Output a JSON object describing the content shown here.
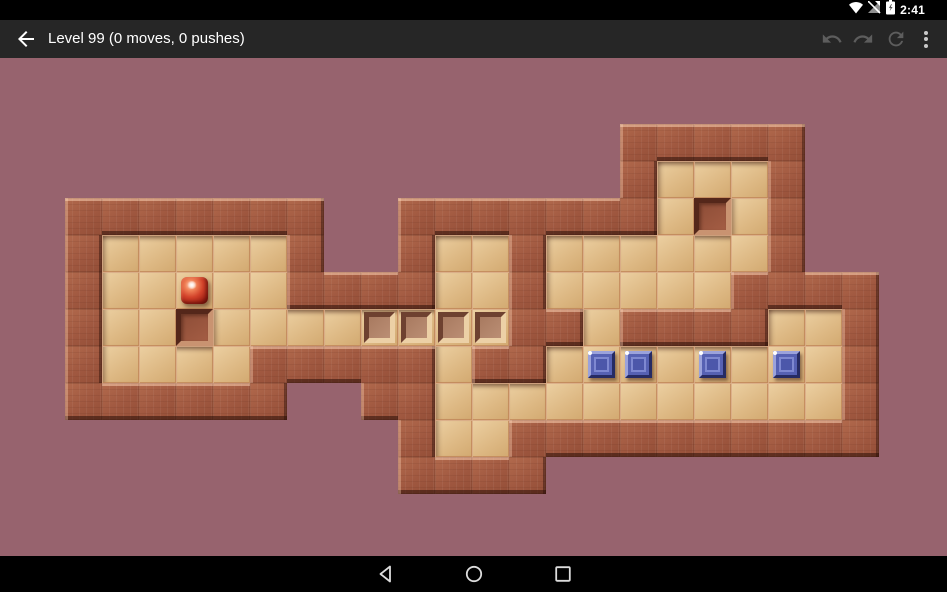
{
  "statusbar": {
    "time": "2:41",
    "icons": [
      "wifi-icon",
      "no-signal-icon",
      "battery-charging-icon"
    ]
  },
  "appbar": {
    "title": "Level 99 (0 moves, 0 pushes)",
    "back_label": "back",
    "actions": [
      "undo",
      "redo",
      "restart",
      "more-options"
    ]
  },
  "game": {
    "level_number": 99,
    "moves": 0,
    "pushes": 0,
    "board": {
      "tile_size": 37,
      "origin_x": 65,
      "origin_y": 66,
      "cols": 22,
      "rows": 10,
      "legend": {
        "#": "wall",
        " ": "outside",
        ".": "floor",
        "*": "goal",
        "$": "box",
        "@": "player"
      },
      "grid": [
        "               #####  ",
        "               #...#  ",
        "#######  #######.#.#  ",
        "#.....#  #..#......#  ",
        "#..@..####..#.....####",
        "#..#....****##.####..#",
        "#....#####.##.$$.$.$.#",
        "######  ##...........#",
        "         #..##########",
        "         ####         "
      ],
      "player": {
        "col": 3,
        "row": 4
      },
      "boxes": [
        {
          "col": 14,
          "row": 6
        },
        {
          "col": 15,
          "row": 6
        },
        {
          "col": 17,
          "row": 6
        },
        {
          "col": 19,
          "row": 6
        }
      ],
      "goals": [
        {
          "col": 8,
          "row": 5
        },
        {
          "col": 9,
          "row": 5
        },
        {
          "col": 10,
          "row": 5
        },
        {
          "col": 11,
          "row": 5
        }
      ]
    },
    "colors": {
      "background": "#97636e",
      "wall": "#a45c42",
      "wall_light_edge": "#d7a887",
      "wall_dark_edge": "#3f1a0f",
      "floor": "#e0bd8a",
      "floor_highlight": "#f5e6c0",
      "floor_shadow": "#b98f5c",
      "grout": "#c6865e",
      "goal_face": "#b2836a",
      "box_face": "#5661b3",
      "box_light": "#9ba2db",
      "box_dark": "#262b63",
      "ball_red": "#d2422a",
      "appbar_bg": "#262626",
      "statusbar_bg": "#000000",
      "navbar_bg": "#000000"
    }
  },
  "navbar": {
    "icons": [
      "back-triangle-icon",
      "home-circle-icon",
      "recents-square-icon"
    ]
  }
}
